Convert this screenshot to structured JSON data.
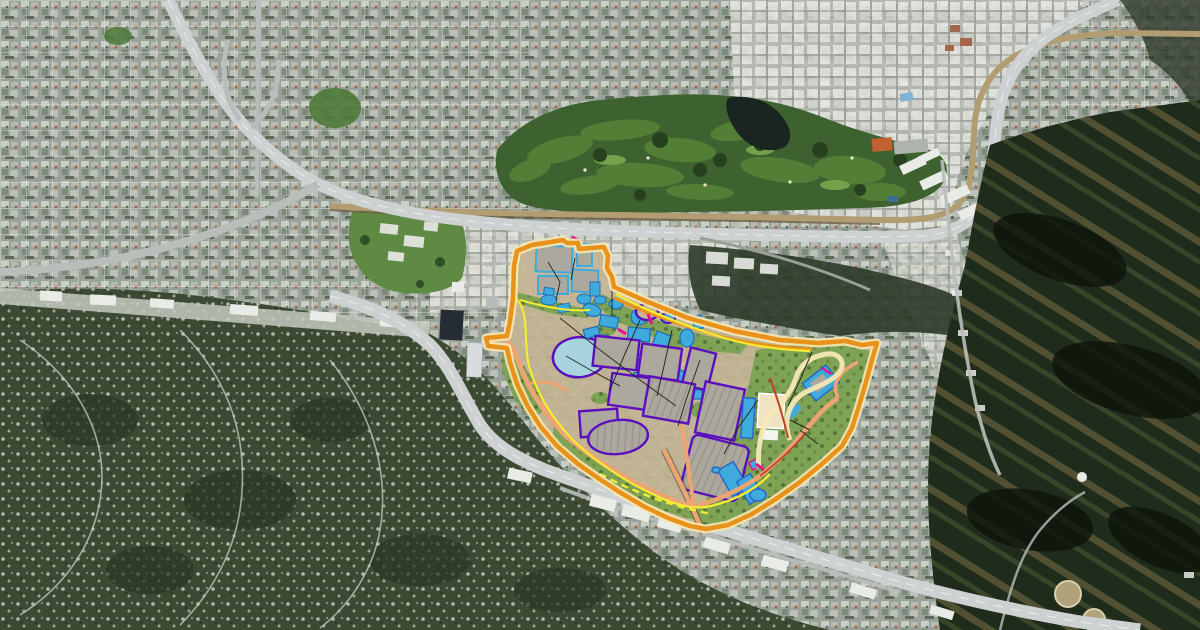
{
  "page": {
    "type": "satellite-map",
    "description": "Aerial satellite photograph of a valley city with a golf course, river channel, two freeways, hillside neighborhoods and dark chaparral hills, overlaid in the center-right with a colored theme-park master-plan drawing (orange boundary, cyan attraction buildings, purple-outlined soundstages and parking structures, green landscape zones, yellow, magenta and salmon route lines)."
  },
  "colors": {
    "city-a": "#99A29A",
    "city-b": "#C9CEC5",
    "city-c": "#7E8B78",
    "city-d": "#B6BBAE",
    "city-e": "#5E6B56",
    "city-rust": "#A5674B",
    "grid-line": "#E4E8E0",
    "roof-base": "#B7BAB2",
    "roof-white": "#E7E9E3",
    "roof-shadow": "#8E9289",
    "golf-dark": "#3E6130",
    "golf-mid": "#527E36",
    "golf-light": "#76A14B",
    "golf-tree": "#27411F",
    "lake": "#1A2520",
    "clubhouse": "#C26032",
    "river-tan": "#B29C72",
    "river-dark": "#6E5F43",
    "road-light": "#CDD1D2",
    "road-mid": "#B9BEBA",
    "road-white": "#EDEFEE",
    "hill-sw-base": "#3C4A33",
    "hill-sw-dot": "#C9CEC2",
    "hill-e-base": "#1F2B1B",
    "hill-e-ridge": "#8A7A4E",
    "hill-e-shadow": "#0D140C",
    "hill-e-olive": "#5C6B3C",
    "campus-green": "#5E8A44",
    "bldg-white": "#E9EBE7",
    "tower-dark": "#262C33",
    "plan-orange": "#E8921A",
    "plan-cream": "#F6E8B6",
    "plan-tan": "#C3B493",
    "plan-green": "#7FA355",
    "plan-tree": "#55743A",
    "plan-gray": "#ACA89E",
    "plan-stripe": "#98948A",
    "plan-purple": "#5B10BE",
    "plan-cyan": "#3FABDC",
    "plan-cyan-dark": "#2371B5",
    "plan-blue": "#2A66C8",
    "plan-lagoon": "#A9D3DE",
    "plan-salmon": "#EDA473",
    "plan-redline": "#C04227",
    "plan-yellow": "#F5EC32",
    "plan-magenta": "#E5128F",
    "plan-beige": "#EFE3C2",
    "plan-black": "#1C1C1C",
    "tank-tan": "#B0A27A",
    "tank-rim": "#D8CFAE"
  },
  "regions": [
    {
      "id": "urban-grid-northwest",
      "kind": "residential street grid"
    },
    {
      "id": "industrial-district-north",
      "kind": "studio warehouse district"
    },
    {
      "id": "golf-course",
      "kind": "golf course with lake and clubhouse"
    },
    {
      "id": "river-channel",
      "kind": "concrete river channel"
    },
    {
      "id": "freeway-upper",
      "kind": "freeway with interchange"
    },
    {
      "id": "freeway-lower",
      "kind": "freeway through pass"
    },
    {
      "id": "green-campus",
      "kind": "landscaped campus park"
    },
    {
      "id": "hillside-residential-southwest",
      "kind": "wooded hillside homes"
    },
    {
      "id": "dark-hills-east",
      "kind": "chaparral hills with water tanks"
    },
    {
      "id": "master-plan-overlay",
      "kind": "colored site-plan drawing"
    }
  ],
  "overlay_features": [
    {
      "id": "plan-boundary",
      "color_ref": "plan-orange"
    },
    {
      "id": "boundary-inner-band",
      "color_ref": "plan-cream"
    },
    {
      "id": "north-lot-stages",
      "color_ref": "plan-gray"
    },
    {
      "id": "attraction-cluster",
      "color_ref": "plan-cyan"
    },
    {
      "id": "lagoon",
      "color_ref": "plan-lagoon"
    },
    {
      "id": "soundstage-blocks",
      "color_ref": "plan-gray"
    },
    {
      "id": "parking-structures",
      "color_ref": "plan-stripe"
    },
    {
      "id": "landscape-zones",
      "color_ref": "plan-green"
    },
    {
      "id": "east-campus-buildings",
      "color_ref": "plan-beige"
    },
    {
      "id": "south-buildings",
      "color_ref": "plan-cyan"
    },
    {
      "id": "internal-roads",
      "color_ref": "plan-salmon"
    },
    {
      "id": "yellow-route-line",
      "color_ref": "plan-yellow"
    },
    {
      "id": "red-road-edges",
      "color_ref": "plan-redline"
    },
    {
      "id": "magenta-accent-marks",
      "color_ref": "plan-magenta"
    },
    {
      "id": "path-lines",
      "color_ref": "plan-black"
    }
  ]
}
